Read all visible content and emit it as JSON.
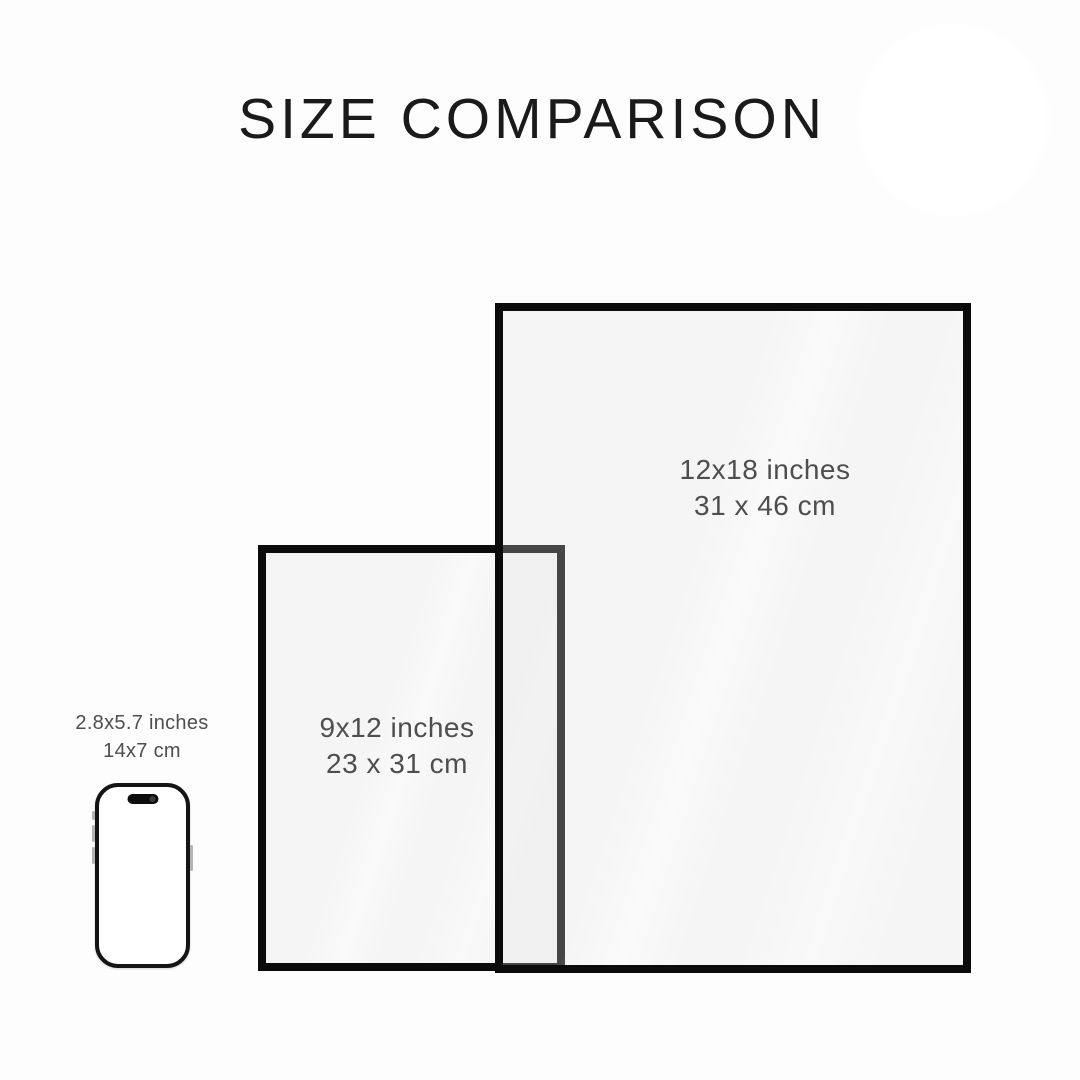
{
  "page": {
    "title": "SIZE COMPARISON"
  },
  "comparison": {
    "large_frame": {
      "size_in": "12x18 inches",
      "size_cm": "31 x 46 cm"
    },
    "medium_frame": {
      "size_in": "9x12 inches",
      "size_cm": "23 x 31 cm"
    },
    "phone": {
      "size_in": "2.8x5.7 inches",
      "size_cm": "14x7 cm"
    }
  },
  "colors": {
    "background": "#fdfdfd",
    "frame_border": "#0b0b0b",
    "paper": "#f6f6f4",
    "overlap_border_seen_through_glass": "#3d3d3d",
    "label_text": "#4e4e4e",
    "title_text": "#1a1a1a",
    "phone_body": "#141414"
  }
}
